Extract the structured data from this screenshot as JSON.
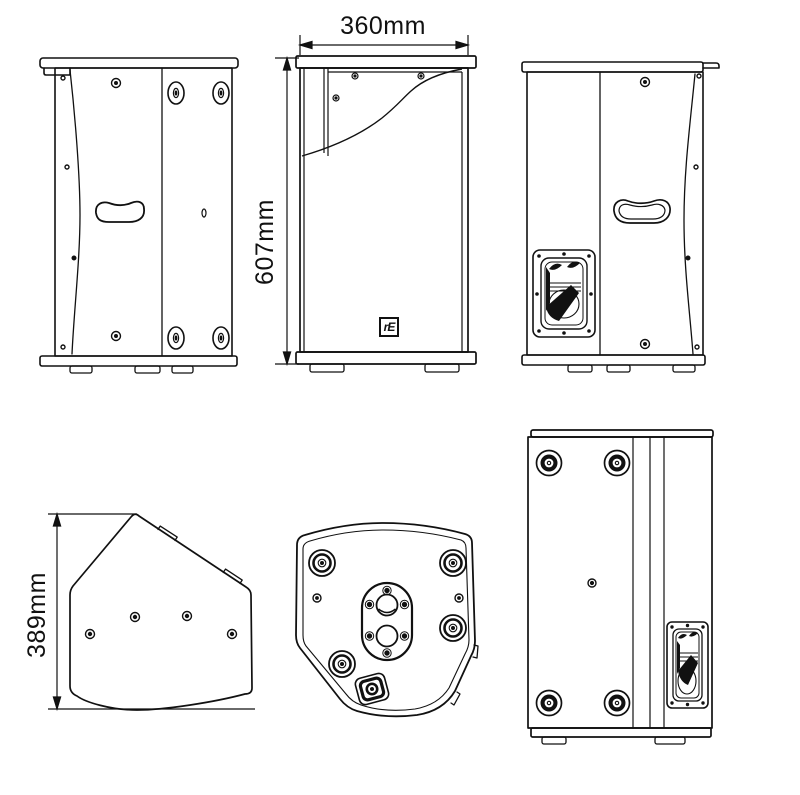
{
  "drawing": {
    "title_hint": "loudspeaker cabinet six-view technical drawing",
    "dimensions": {
      "width_label": "360mm",
      "height_label": "607mm",
      "depth_label": "389mm"
    },
    "logo_text": "rE",
    "colors": {
      "line": "#111111",
      "background": "#ffffff"
    }
  }
}
